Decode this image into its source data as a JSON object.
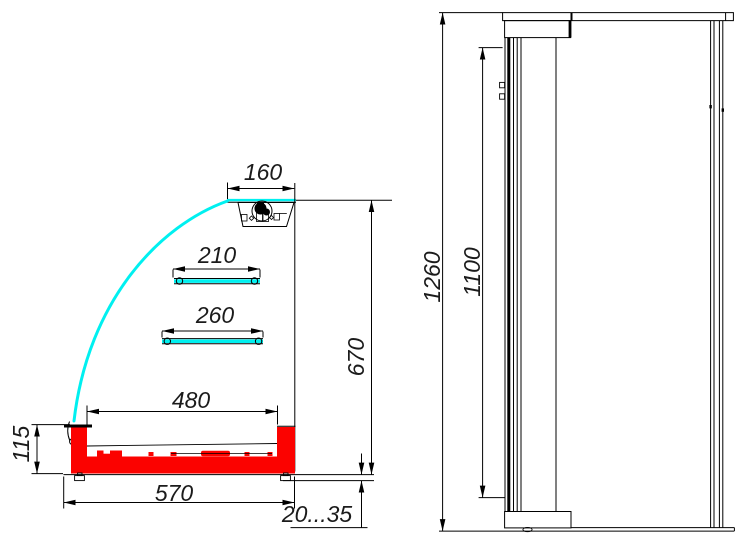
{
  "drawing": {
    "type": "technical-dimension-drawing",
    "subject": "refrigerated-display-case",
    "views": {
      "side_section": {
        "label": "side section view",
        "dimensions": {
          "canopy_width": "160",
          "upper_shelf": "210",
          "lower_shelf": "260",
          "well_width": "480",
          "base_width": "570",
          "base_height": "115",
          "body_height": "670",
          "leg_height_range": "20...35"
        }
      },
      "front_view": {
        "label": "front view",
        "dimensions": {
          "overall_height": "1260",
          "glass_height": "1100"
        }
      }
    },
    "colors": {
      "glass_cyan": "#00f0f0",
      "base_red": "#fb0200",
      "line_black": "#000000"
    }
  }
}
